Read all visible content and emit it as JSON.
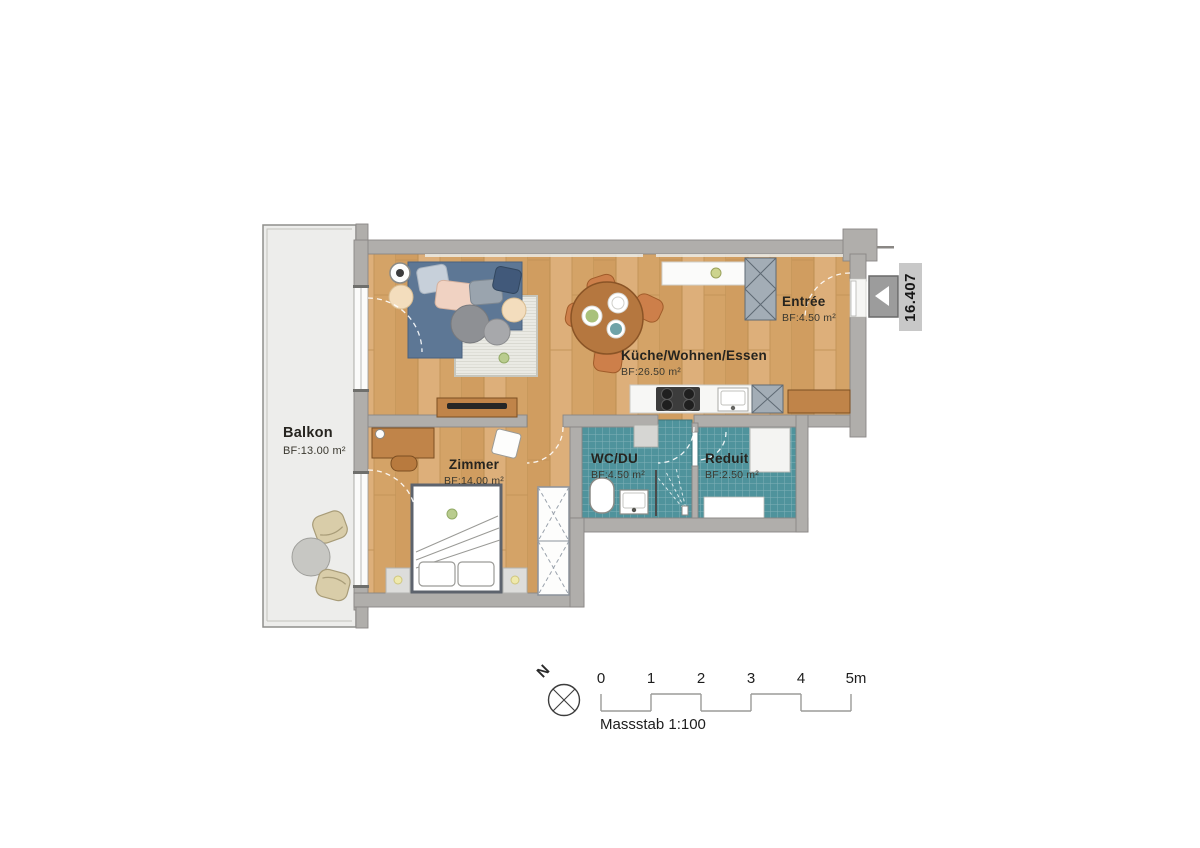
{
  "plan": {
    "rooms": {
      "balkon": {
        "name": "Balkon",
        "area": "BF:13.00 m²"
      },
      "kueche": {
        "name": "Küche/Wohnen/Essen",
        "area": "BF:26.50 m²"
      },
      "entree": {
        "name": "Entrée",
        "area": "BF:4.50 m²"
      },
      "zimmer": {
        "name": "Zimmer",
        "area": "BF:14.00 m²"
      },
      "wc": {
        "name": "WC/DU",
        "area": "BF:4.50 m²"
      },
      "reduit": {
        "name": "Reduit",
        "area": "BF:2.50 m²"
      }
    },
    "unit_label": "16.407",
    "compass": {
      "north": "N"
    },
    "scale_bar": {
      "ticks": [
        "0",
        "1",
        "2",
        "3",
        "4",
        "5m"
      ],
      "caption": "Massstab 1:100"
    },
    "colors": {
      "wall": "#b0aeab",
      "wood_floor": "#d7a76d",
      "tile_floor": "#4f939c",
      "balcony_floor": "#ededeb",
      "sofa": "#5d7795",
      "furniture_wood": "#c08449",
      "unit_tag_bg": "#c8c8c8"
    }
  }
}
